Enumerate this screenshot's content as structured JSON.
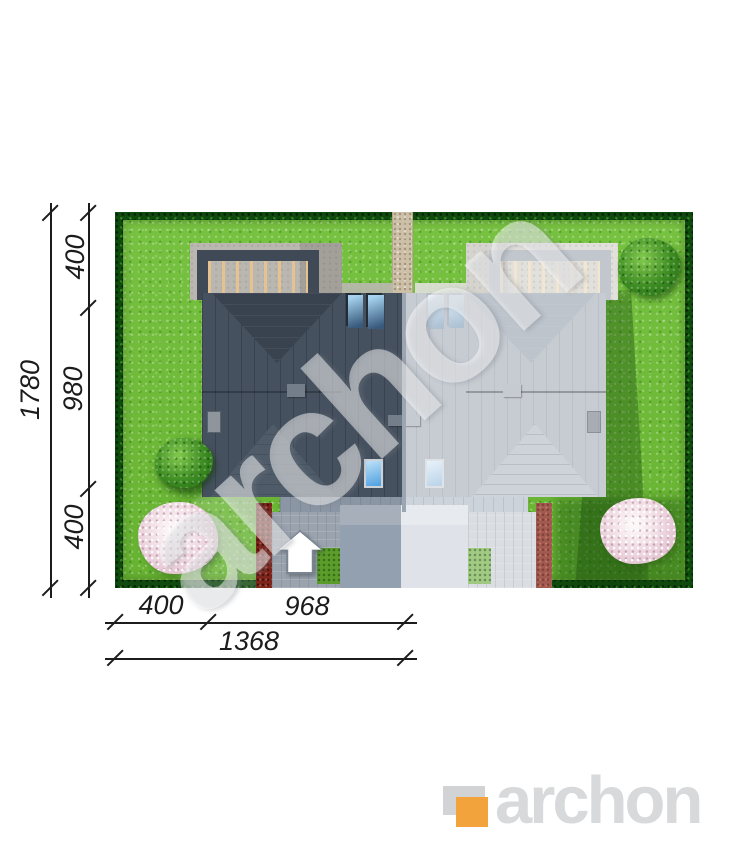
{
  "watermark": {
    "text": "archon"
  },
  "logo": {
    "text": "archon"
  },
  "dimensions": {
    "left_segments": [
      "400",
      "980",
      "400"
    ],
    "left_total": "1780",
    "bottom_segments": [
      "400",
      "968"
    ],
    "bottom_total": "1368"
  },
  "colors": {
    "grass": "#6fbe35",
    "hedge": "#0f4a0e",
    "roof_dark": "#46515f",
    "roof_faded": "#c7ccd3",
    "concrete": "#bab7b0",
    "path": "#cdc0a8",
    "driveway": "#93a0b0",
    "red_hedge": "#7d241b",
    "tree_bloom": "#ecd2dc",
    "accent_orange": "#f2a33c",
    "logo_gray": "#d8d9da",
    "dimension_ink": "#1c1c1c",
    "watermark": "rgba(255,255,255,0.48)"
  }
}
